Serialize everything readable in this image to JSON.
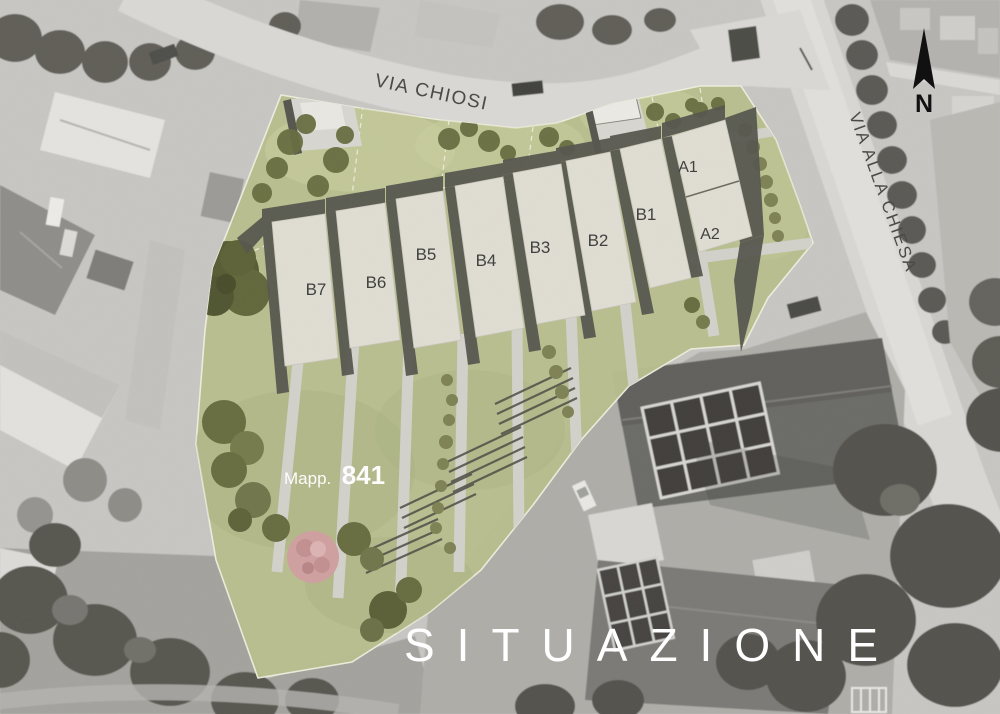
{
  "title": "SITUAZIONE",
  "north": {
    "label": "N"
  },
  "streets": {
    "via_chiosi": "VIA CHIOSI",
    "via_alla_chiesa": "VIA ALLA CHIESA"
  },
  "parcel": {
    "prefix": "Mapp.",
    "number": "841"
  },
  "buildings": [
    {
      "label": "B7"
    },
    {
      "label": "B6"
    },
    {
      "label": "B5"
    },
    {
      "label": "B4"
    },
    {
      "label": "B3"
    },
    {
      "label": "B2"
    },
    {
      "label": "B1"
    },
    {
      "label": "A1"
    },
    {
      "label": "A2"
    }
  ],
  "colors": {
    "site_green": "#b8be8d",
    "building_fill": "#e0ddd3",
    "shadow": "#55554d",
    "path": "#d2d1ca",
    "tree_olive": "#676c3f",
    "tree_pink": "#cf9f9f",
    "photo_base": "#c7c6c3",
    "road": "#d9d8d5",
    "label_dark": "#3d3d3b",
    "street_label": "#4a4a47",
    "text_white": "#ffffff"
  }
}
